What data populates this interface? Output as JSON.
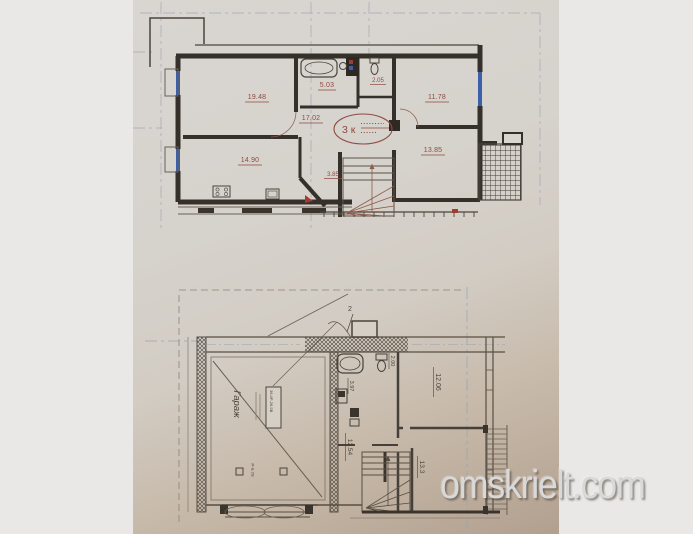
{
  "page": {
    "background_color": "#e9e8e6"
  },
  "photo": {
    "paper_top_color": "#d8d5d1",
    "paper_bottom_color": "#b2a08f"
  },
  "watermark": {
    "text": "omskrielt.com",
    "color": "#d9d9d9"
  },
  "upper_plan": {
    "stamp": "3 к",
    "rooms": {
      "living": "19.48",
      "bath": "5.03",
      "wc": "2.05",
      "bedroom": "11.78",
      "hall": "17.02",
      "kitchen": "14.90",
      "room": "13.85",
      "stairs": "3.85"
    }
  },
  "lower_plan": {
    "garage": "Гараж",
    "rooms": {
      "corridor": "3.97",
      "wc": "2.00",
      "room1": "12.06",
      "hall": "12.54",
      "room2": "13.3"
    },
    "marks": {
      "level": "2",
      "door": "Р-9.78",
      "note": "36.4Р-26.5В"
    }
  },
  "colors": {
    "dimension_text": "#8f4a41",
    "walls": "#36302a",
    "window_marks": "#3b5fa8",
    "lower_text": "#4a443c"
  }
}
